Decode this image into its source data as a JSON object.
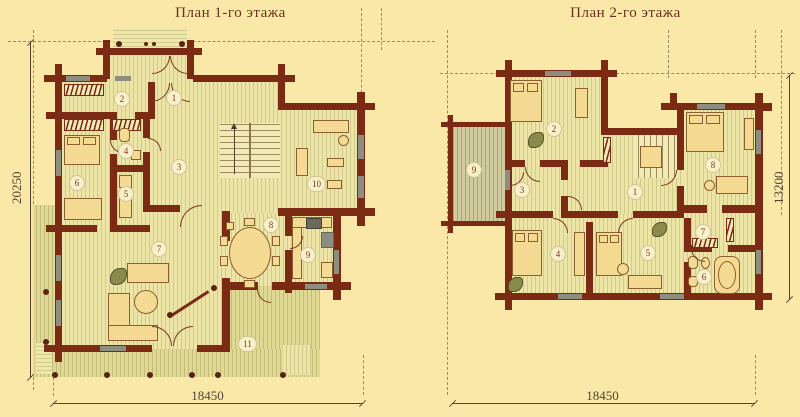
{
  "plan1": {
    "title": "План 1-го этажа",
    "dim_left": "20250",
    "dim_bottom": "18450",
    "rooms": [
      "1",
      "2",
      "3",
      "4",
      "5",
      "6",
      "7",
      "8",
      "9",
      "10",
      "11"
    ]
  },
  "plan2": {
    "title": "План 2-го этажа",
    "dim_right": "13200",
    "dim_bottom": "18450",
    "rooms": [
      "1",
      "2",
      "3",
      "4",
      "5",
      "6",
      "7",
      "8",
      "9"
    ]
  },
  "colors": {
    "background": "#f9e8a7",
    "wall": "#7b2a14",
    "floor_stripe": "#ece5a6",
    "terrace_stripe": "#e0d993",
    "window_gray": "#8d8d82",
    "dim_text": "#554433",
    "title_text": "#6b3020"
  }
}
